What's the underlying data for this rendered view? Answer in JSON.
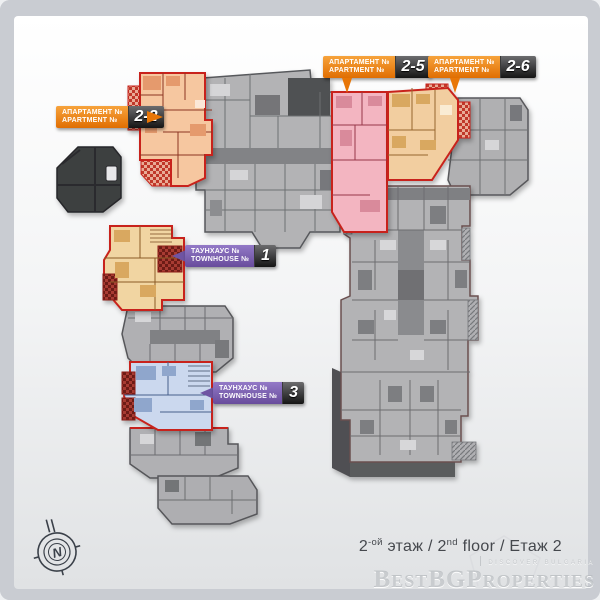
{
  "callouts": [
    {
      "type": "apartment",
      "line1": "АПАРТАМЕНТ №",
      "line2": "APARTMENT №",
      "number": "2-2",
      "color": "#ef7c04"
    },
    {
      "type": "apartment",
      "line1": "АПАРТАМЕНТ №",
      "line2": "APARTMENT №",
      "number": "2-5",
      "color": "#ef7c04"
    },
    {
      "type": "apartment",
      "line1": "АПАРТАМЕНТ №",
      "line2": "APARTMENT №",
      "number": "2-6",
      "color": "#ef7c04"
    },
    {
      "type": "townhouse",
      "line1": "ТАУНХАУС №",
      "line2": "TOWNHOUSE №",
      "number": "1",
      "color": "#7257a6"
    },
    {
      "type": "townhouse",
      "line1": "ТАУНХАУС №",
      "line2": "TOWNHOUSE №",
      "number": "3",
      "color": "#7257a6"
    }
  ],
  "footer": {
    "ru_num": "2",
    "ru_sup": "-ой",
    "mid": " этаж / 2",
    "en_sup": "nd",
    "rest": " floor / Етаж 2"
  },
  "watermark": {
    "tagline": "discover bulgaria",
    "brand": "BestBGProperties"
  },
  "compass": {
    "label": "N"
  },
  "colors": {
    "frame": "#c9ccd2",
    "outline_red": "#c8241a",
    "label_orange": "#ef7c04",
    "label_purple": "#7257a6",
    "plan_gray": "#b3b3b5",
    "unit_2_2": "#f6c7a0",
    "unit_2_5": "#f3b5c1",
    "unit_2_6": "#f2cea0",
    "townhouse_1": "#f1d5a2",
    "townhouse_3": "#cbd8ee"
  }
}
